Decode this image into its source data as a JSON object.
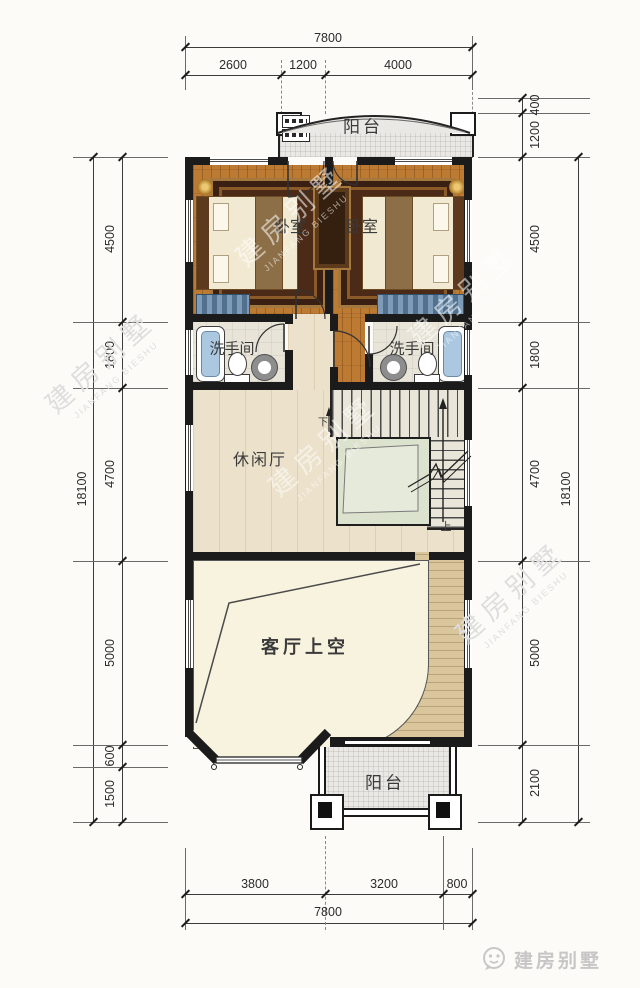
{
  "rooms": {
    "balcony_top": "阳台",
    "bedroom_left": "卧室",
    "bedroom_right": "卧室",
    "bath_left": "洗手间",
    "bath_right": "洗手间",
    "lounge": "休闲厅",
    "living_void": "客厅上空",
    "balcony_bottom": "阳台",
    "stair_up": "上",
    "stair_down": "下"
  },
  "dims": {
    "top": {
      "segments": [
        "2600",
        "1200",
        "4000"
      ],
      "total": "7800"
    },
    "bottom": {
      "segments": [
        "3800",
        "3200",
        "800"
      ],
      "total": "7800"
    },
    "left": {
      "segments": [
        "4500",
        "1800",
        "4700",
        "5000",
        "600",
        "1500"
      ],
      "total": "18100"
    },
    "right": {
      "segments": [
        "400",
        "1200",
        "4500",
        "1800",
        "4700",
        "5000",
        "2100"
      ],
      "total": "18100"
    }
  },
  "watermark": {
    "cn": "建房别墅",
    "en": "JIANFANG BIESHU"
  },
  "logo": {
    "text": "建房别墅"
  },
  "colors": {
    "wall": "#1b1b1b",
    "bedroom_floor": "#bd7a33",
    "lounge_floor": "#ece1ca",
    "void_floor": "#f8f3df",
    "walkway_floor": "#d9c69c",
    "stair_void": "#dbe2cd",
    "balcony_floor": "#e9e8e4",
    "bathtub": "#abc8e0",
    "cabinet_blue": "#6f8fae",
    "rug": "#4b2a17",
    "dim_text": "#2b2b2b"
  }
}
